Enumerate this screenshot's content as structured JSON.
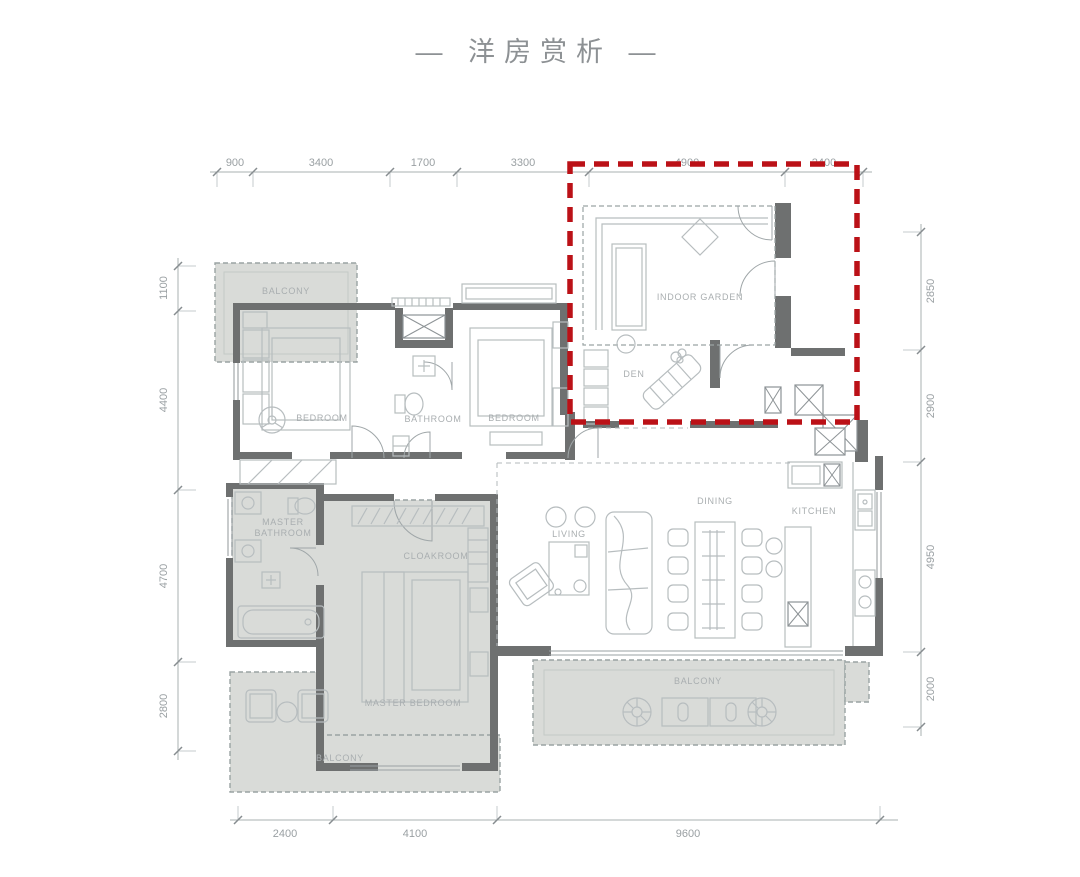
{
  "title": "— 洋房赏析 —",
  "dims": {
    "top": [
      "900",
      "3400",
      "1700",
      "3300",
      "4900",
      "2400"
    ],
    "left": [
      "1100",
      "4400",
      "4700",
      "2800"
    ],
    "right": [
      "2850",
      "2900",
      "4950",
      "2000"
    ],
    "bottom": [
      "2400",
      "4100",
      "9600"
    ]
  },
  "rooms": {
    "balcony_tl": "BALCONY",
    "bedroom_1": "BEDROOM",
    "bathroom": "BATHROOM",
    "bedroom_2": "BEDROOM",
    "indoor_garden": "INDOOR GARDEN",
    "den": "DEN",
    "living": "LIVING",
    "dining": "DINING",
    "kitchen": "KITCHEN",
    "master_bath_line1": "MASTER",
    "master_bath_line2": "BATHROOM",
    "cloakroom": "CLOAKROOM",
    "master_bedroom": "MASTER BEDROOM",
    "balcony_br": "BALCONY",
    "balcony_bl": "BALCONY"
  },
  "highlight": {
    "color": "#bb1117"
  }
}
